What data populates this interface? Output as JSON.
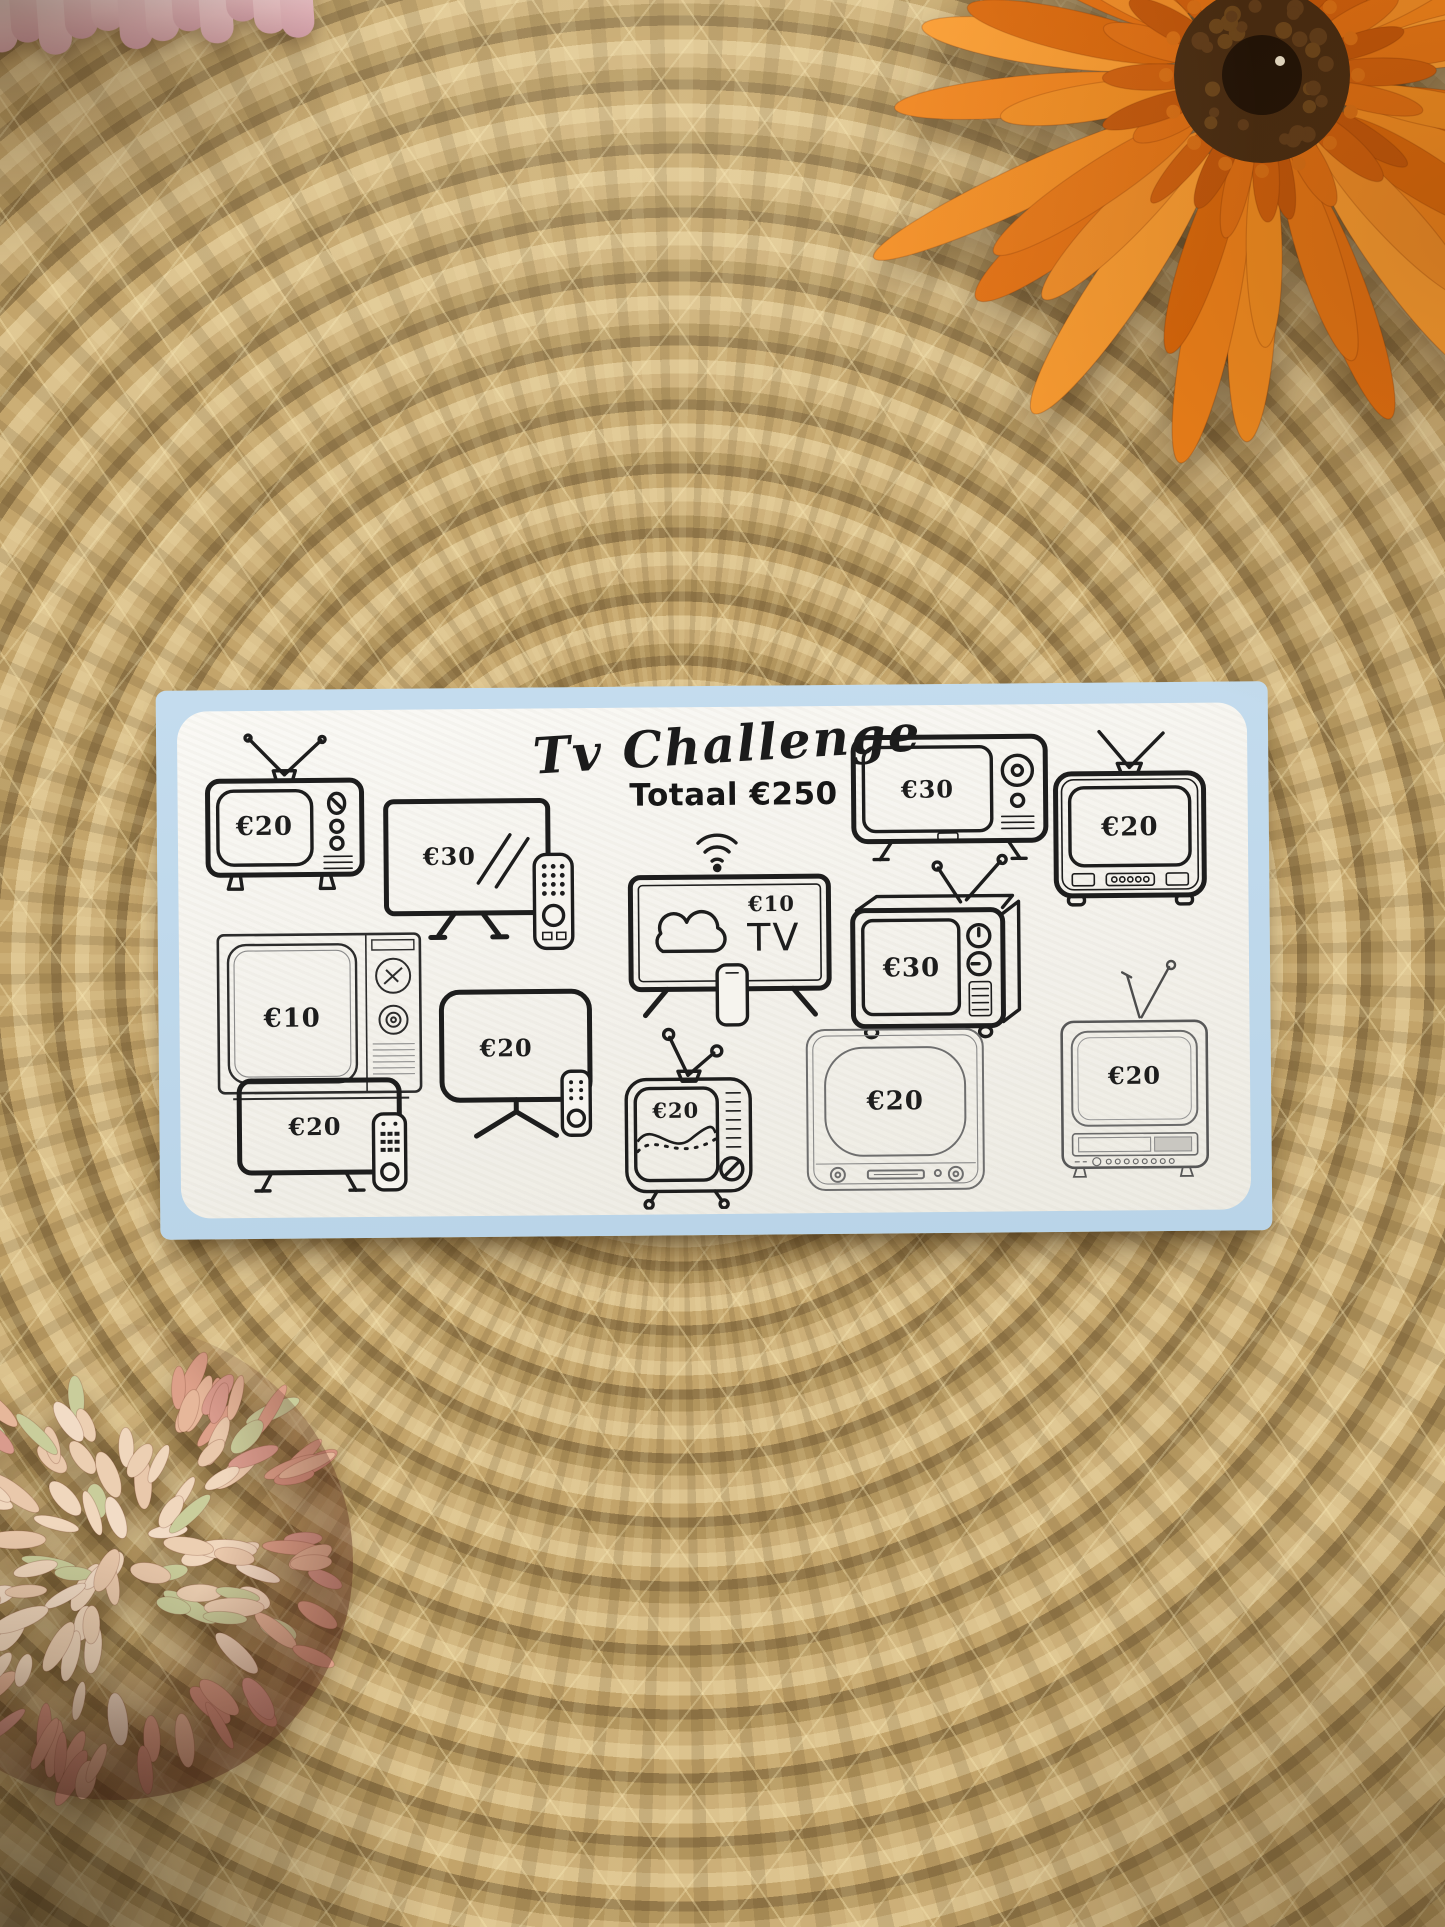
{
  "card": {
    "title": "Tv Challenge",
    "subtitle": "Totaal €250",
    "tvs": [
      {
        "name": "retro antenna tv",
        "amount": "€20"
      },
      {
        "name": "flatscreen remote tv",
        "amount": "€30"
      },
      {
        "name": "retro knob tv",
        "amount": "€30"
      },
      {
        "name": "portable antenna tv",
        "amount": "€20"
      },
      {
        "name": "vintage dial tv",
        "amount": "€10"
      },
      {
        "name": "monitor remote tv",
        "amount": "€20"
      },
      {
        "name": "smart streaming tv",
        "amount": "€10",
        "screen_text": "TV"
      },
      {
        "name": "retro box tv",
        "amount": "€30"
      },
      {
        "name": "lowboard remote tv",
        "amount": "€20"
      },
      {
        "name": "wave screen tv",
        "amount": "€20"
      },
      {
        "name": "fifties console tv",
        "amount": "€20"
      },
      {
        "name": "vcr combo tv",
        "amount": "€20"
      }
    ],
    "accent_color": "#bdd7e9",
    "ink_color": "#1d1d1d"
  }
}
